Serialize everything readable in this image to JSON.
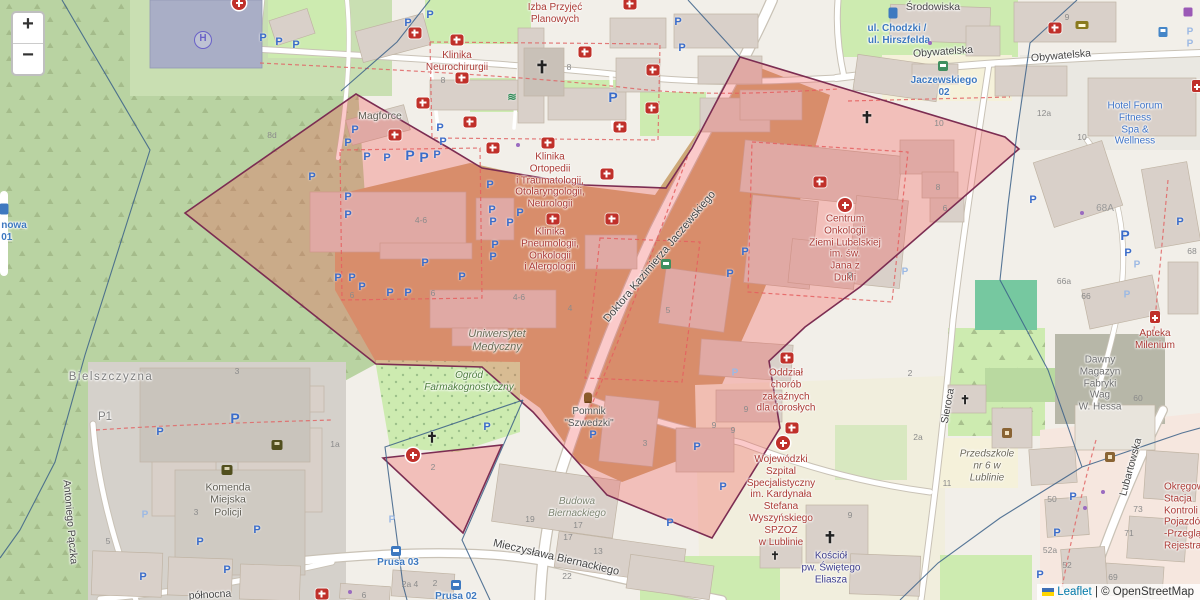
{
  "controls": {
    "zoom_in": "+",
    "zoom_out": "−"
  },
  "attribution": {
    "leaflet": "Leaflet",
    "separator": "|",
    "osm": "© OpenStreetMap"
  },
  "glyphs": {
    "parking": "P",
    "church": "✝",
    "helipad": "H",
    "swim": "≋"
  },
  "colors": {
    "overlay_fill": "#f25050",
    "overlay_border": "#7c2d52",
    "boundary_line": "#3b6088",
    "forest": "#b9d3a2",
    "grass": "#cdebb0",
    "brownfield": "#cda878",
    "building": "#d9d0c9",
    "road": "#ffffff",
    "parking_blue": "#3a6cc9",
    "hospital_red": "#c0302a"
  },
  "streets": {
    "srodowiska": "Środowiska",
    "obywatelska": "Obywatelska",
    "jaczewskiego": "Doktora Kazimierza Jaczewskiego",
    "biernackiego": "Mieczysława Biernackiego",
    "sieroca": "Sieroca",
    "lubartowska": "Lubartowska",
    "paczka": "Antoniego Pączka",
    "polnocna": "północna"
  },
  "stops": {
    "chodzki": "ul. Chodzki /",
    "hirszfelda": "ul. Hirszfelda",
    "jaczewskiego02": "Jaczewskiego\n02",
    "prusa03": "Prusa 03",
    "prusa02": "Prusa 02",
    "nowa": "nowa\n01"
  },
  "places": {
    "bielszczyzna": "Bielszczyzna",
    "p1": "P1",
    "magforce": "Magforce"
  },
  "pois": {
    "izba": "Izba Przyjęć\nPlanowych",
    "neurochirurgia": "Klinika\nNeurochirurgii",
    "ortopedia": "Klinika\nOrtopedii\ni Traumatologii,\nOtolaryngologii,\nNeurologii",
    "pneumologia": "Klinika\nPneumologii,\nOnkologii\ni Alergologii",
    "uniwersytet": "Uniwersytet\nMedyczny",
    "ogrod": "Ogród\nFarmakognostyczny",
    "pomnik": "Pomnik\n\"Szwedzki\"",
    "centrum_onkologii": "Centrum\nOnkologii\nZiemi Lubelskiej\nim. św.\nJana z\nDukli",
    "oddzial": "Oddział\nchorób\nzakaźnych\ndla dorosłych",
    "wojewodzki": "Wojewódzki\nSzpital\nSpecjalistyczny\nim. Kardynała\nStefana\nWyszyńskiego\nSPZOZ\nw Lublinie",
    "kosciol": "Kościół\npw. Świętego\nEliasza",
    "komenda": "Komenda\nMiejska\nPolicji",
    "hotel": "Hotel Forum\nFitness\nSpa & Wellness",
    "apteka": "Apteka\nMilenium",
    "dawny_magazyn": "Dawny\nMagazyn\nFabryki\nWag\nW. Hessa",
    "przedszkole": "Przedszkole\nnr 6 w\nLublinie",
    "okregowa": "Okręgowa\nStacja\nKontroli\nPojazdów\n-Przeglądy\nRejestracyjne",
    "budowa": "Budowa\nBiernackiego"
  },
  "numbers": [
    "8d",
    "8",
    "8",
    "4-6",
    "4-6",
    "6",
    "6",
    "4",
    "5",
    "9",
    "8",
    "6",
    "3",
    "9",
    "9",
    "9",
    "2",
    "2a",
    "11",
    "9",
    "12a",
    "10",
    "9",
    "10",
    "68A",
    "66a",
    "66",
    "68",
    "60",
    "73",
    "71",
    "52a",
    "52",
    "69",
    "50",
    "3",
    "3",
    "5",
    "1a",
    "19",
    "17",
    "17",
    "13",
    "22",
    "2",
    "2a 4",
    "2",
    "6"
  ]
}
